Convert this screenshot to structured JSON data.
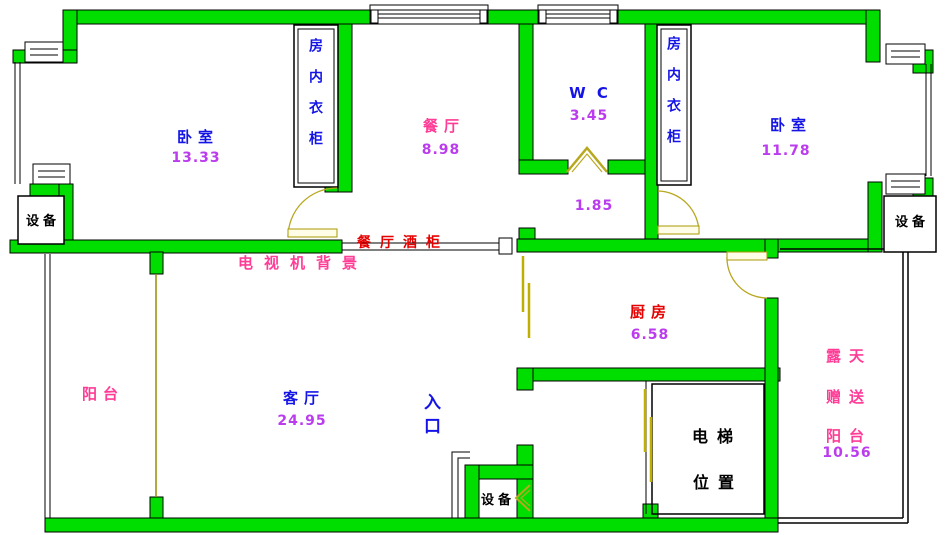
{
  "colors": {
    "wall_green": "#00DE00",
    "room_name_blue": "#1414E6",
    "area_violet": "#BB3CEE",
    "accent_pink": "#FF3C96",
    "accent_red": "#E60000",
    "door_olive": "#B8A820",
    "text_black": "#000000"
  },
  "rooms": {
    "bedroom_left": {
      "name": "卧室",
      "area": "13.33"
    },
    "dining": {
      "name": "餐厅",
      "area": "8.98"
    },
    "wc": {
      "name": "W C",
      "area": "3.45"
    },
    "bedroom_right": {
      "name": "卧室",
      "area": "11.78"
    },
    "hallway": {
      "area": "1.85"
    },
    "living": {
      "name": "客厅",
      "area": "24.95"
    },
    "balcony": {
      "name": "阳台"
    },
    "kitchen": {
      "name": "厨房",
      "area": "6.58"
    },
    "open_balcony": {
      "line1": "露天",
      "line2": "赠送",
      "line3": "阳台",
      "area": "10.56"
    },
    "elevator": {
      "line1": "电梯",
      "line2": "位置"
    },
    "entrance": {
      "label": "入口"
    }
  },
  "fixtures": {
    "wardrobe_left": "房内衣柜",
    "wardrobe_right": "房内衣柜",
    "equipment_top_left": "设备",
    "equipment_top_right": "设备",
    "equipment_bottom": "设备",
    "tv_wall": "电视机背景",
    "wine_cabinet": "餐厅酒柜"
  }
}
